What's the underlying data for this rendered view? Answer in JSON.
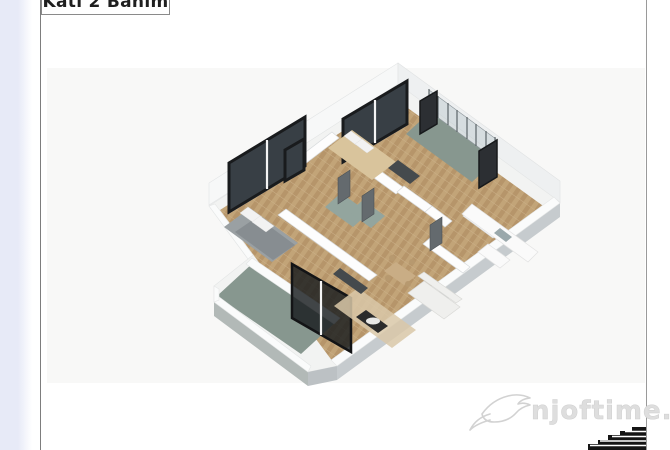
{
  "page": {
    "floor_label": "Kati 2 Banim"
  },
  "watermark": {
    "text": "njoftime.al",
    "logo": "swallow-bird-icon"
  },
  "graphic": {
    "type": "isometric-3d-floor-plan",
    "elements": [
      "bedroom-1",
      "bedroom-2",
      "bathroom",
      "hallway",
      "living-room",
      "kitchen",
      "balcony-top-right",
      "balcony-bottom-left",
      "windows",
      "sliding-glass-door",
      "stairs-graphic"
    ]
  },
  "colors": {
    "accentStrip": "#e7eaf7",
    "line": "#7d7d7d",
    "labelText": "#1f1f1f",
    "wallTop": "#f4f5f4",
    "wallSide": "#c6cbce",
    "wood": "#c2a478",
    "wood2": "#b6956a",
    "balcony": "#87978f",
    "bath": "#93a59e",
    "frame": "#191b1d",
    "watermark": "#dedede"
  }
}
